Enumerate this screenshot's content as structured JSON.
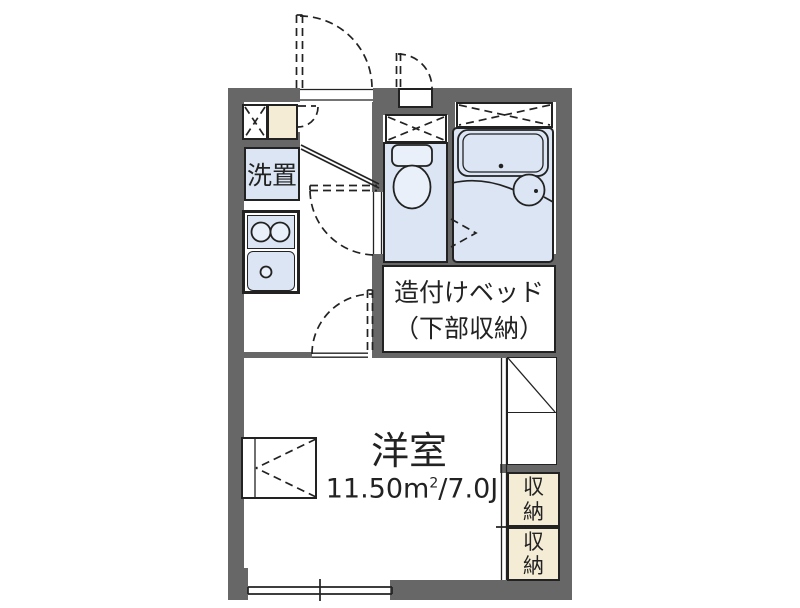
{
  "colors": {
    "wall": "#676767",
    "wet_area_fill": "#dbe5f3",
    "storage_fill": "#f5ecd6",
    "line": "#222222",
    "paper": "#ffffff"
  },
  "plan": {
    "laundry_label": "洗置",
    "bed_label_line1": "造付けベッド",
    "bed_label_line2": "（下部収納）",
    "main_room_name": "洋室",
    "main_room_area_value": "11.50m",
    "main_room_area_sup": "2",
    "main_room_area_suffix": "/7.0J",
    "storage_top_label": "収納",
    "storage_bottom_label": "収納"
  }
}
